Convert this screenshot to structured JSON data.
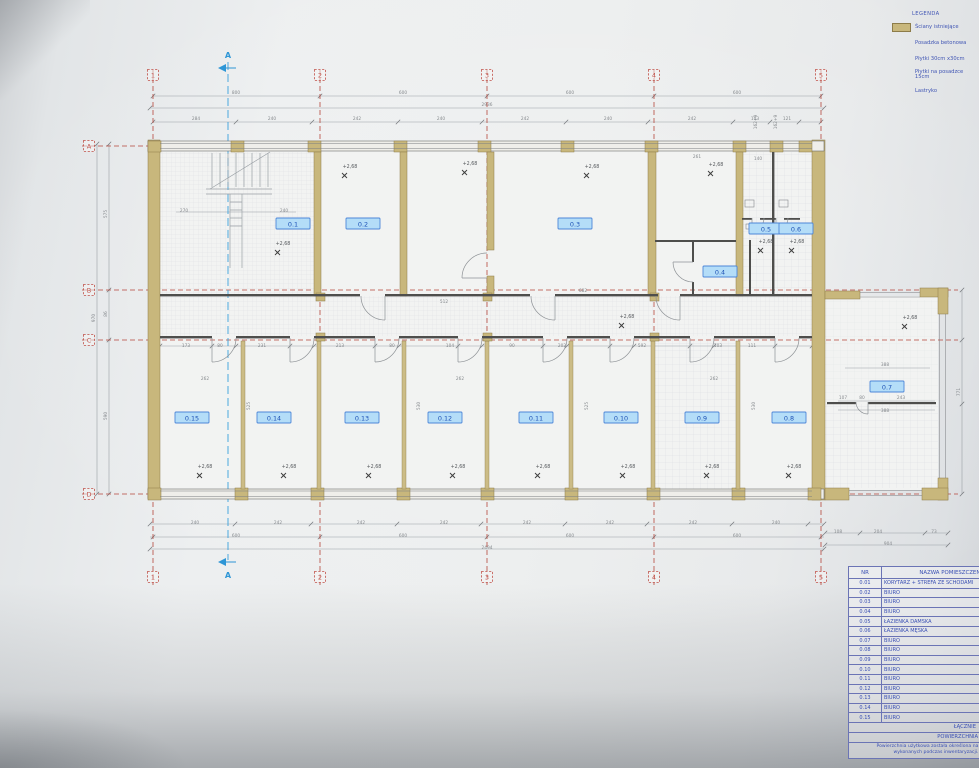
{
  "legend": {
    "title": "LEGENDA",
    "items": [
      {
        "label": "Ściany istniejące",
        "swatch": true
      },
      {
        "label": "Posadzka betonowa",
        "swatch": false
      },
      {
        "label": "Płytki 30cm x30cm",
        "swatch": false
      },
      {
        "label": "Płytki na posadzce 15cm",
        "swatch": false
      },
      {
        "label": "Lastryko",
        "swatch": false
      }
    ]
  },
  "plan": {
    "level_value": "+2,68",
    "section": {
      "label": "A"
    },
    "grid_cols": [
      {
        "label": "1",
        "x": 153
      },
      {
        "label": "2",
        "x": 320
      },
      {
        "label": "3",
        "x": 487
      },
      {
        "label": "4",
        "x": 654
      },
      {
        "label": "5",
        "x": 821
      }
    ],
    "grid_rows": [
      {
        "label": "A",
        "y": 146
      },
      {
        "label": "B",
        "y": 290
      },
      {
        "label": "C",
        "y": 340
      },
      {
        "label": "D",
        "y": 494
      }
    ],
    "room_labels": [
      {
        "id": "0.1",
        "x": 293,
        "y": 224
      },
      {
        "id": "0.2",
        "x": 363,
        "y": 224
      },
      {
        "id": "0.3",
        "x": 575,
        "y": 224
      },
      {
        "id": "0.4",
        "x": 720,
        "y": 272
      },
      {
        "id": "0.5",
        "x": 766,
        "y": 229
      },
      {
        "id": "0.6",
        "x": 796,
        "y": 229
      },
      {
        "id": "0.7",
        "x": 887,
        "y": 387
      },
      {
        "id": "0.8",
        "x": 789,
        "y": 418
      },
      {
        "id": "0.9",
        "x": 702,
        "y": 418
      },
      {
        "id": "0.10",
        "x": 621,
        "y": 418
      },
      {
        "id": "0.11",
        "x": 536,
        "y": 418
      },
      {
        "id": "0.12",
        "x": 445,
        "y": 418
      },
      {
        "id": "0.13",
        "x": 362,
        "y": 418
      },
      {
        "id": "0.14",
        "x": 274,
        "y": 418
      },
      {
        "id": "0.15",
        "x": 192,
        "y": 418
      }
    ],
    "level_markers": [
      {
        "x": 283,
        "y": 245
      },
      {
        "x": 350,
        "y": 168
      },
      {
        "x": 470,
        "y": 165
      },
      {
        "x": 592,
        "y": 168
      },
      {
        "x": 716,
        "y": 166
      },
      {
        "x": 766,
        "y": 243
      },
      {
        "x": 797,
        "y": 243
      },
      {
        "x": 627,
        "y": 318
      },
      {
        "x": 910,
        "y": 319
      },
      {
        "x": 205,
        "y": 468
      },
      {
        "x": 289,
        "y": 468
      },
      {
        "x": 374,
        "y": 468
      },
      {
        "x": 458,
        "y": 468
      },
      {
        "x": 543,
        "y": 468
      },
      {
        "x": 628,
        "y": 468
      },
      {
        "x": 712,
        "y": 468
      },
      {
        "x": 794,
        "y": 468
      }
    ],
    "dims": [
      {
        "t": "800",
        "x": 236,
        "y": 94
      },
      {
        "t": "600",
        "x": 403,
        "y": 94
      },
      {
        "t": "600",
        "x": 570,
        "y": 94
      },
      {
        "t": "600",
        "x": 737,
        "y": 94
      },
      {
        "t": "2936",
        "x": 487,
        "y": 106
      },
      {
        "t": "284",
        "x": 196,
        "y": 120
      },
      {
        "t": "240",
        "x": 272,
        "y": 120
      },
      {
        "t": "242",
        "x": 357,
        "y": 120
      },
      {
        "t": "240",
        "x": 441,
        "y": 120
      },
      {
        "t": "242",
        "x": 525,
        "y": 120
      },
      {
        "t": "240",
        "x": 608,
        "y": 120
      },
      {
        "t": "242",
        "x": 692,
        "y": 120
      },
      {
        "t": "103",
        "x": 755,
        "y": 120
      },
      {
        "t": "121",
        "x": 787,
        "y": 120
      },
      {
        "t": "270",
        "x": 184,
        "y": 212
      },
      {
        "t": "240",
        "x": 284,
        "y": 212
      },
      {
        "t": "261",
        "x": 697,
        "y": 158
      },
      {
        "t": "140",
        "x": 758,
        "y": 160
      },
      {
        "t": "162+9",
        "x": 757,
        "y": 122,
        "r": 1
      },
      {
        "t": "162+9",
        "x": 777,
        "y": 122,
        "r": 1
      },
      {
        "t": "682",
        "x": 583,
        "y": 292
      },
      {
        "t": "512",
        "x": 444,
        "y": 303
      },
      {
        "t": "173",
        "x": 186,
        "y": 347
      },
      {
        "t": "80",
        "x": 220,
        "y": 347
      },
      {
        "t": "231",
        "x": 262,
        "y": 347
      },
      {
        "t": "213",
        "x": 340,
        "y": 347
      },
      {
        "t": "80",
        "x": 392,
        "y": 347
      },
      {
        "t": "104",
        "x": 450,
        "y": 347
      },
      {
        "t": "90",
        "x": 512,
        "y": 347
      },
      {
        "t": "202",
        "x": 562,
        "y": 347
      },
      {
        "t": "592",
        "x": 642,
        "y": 347
      },
      {
        "t": "103",
        "x": 718,
        "y": 347
      },
      {
        "t": "111",
        "x": 752,
        "y": 347
      },
      {
        "t": "262",
        "x": 205,
        "y": 380
      },
      {
        "t": "262",
        "x": 460,
        "y": 380
      },
      {
        "t": "262",
        "x": 714,
        "y": 380
      },
      {
        "t": "525",
        "x": 250,
        "y": 406,
        "r": 1
      },
      {
        "t": "530",
        "x": 420,
        "y": 406,
        "r": 1
      },
      {
        "t": "525",
        "x": 588,
        "y": 406,
        "r": 1
      },
      {
        "t": "530",
        "x": 755,
        "y": 406,
        "r": 1
      },
      {
        "t": "388",
        "x": 885,
        "y": 366
      },
      {
        "t": "107",
        "x": 843,
        "y": 399
      },
      {
        "t": "80",
        "x": 862,
        "y": 399
      },
      {
        "t": "243",
        "x": 901,
        "y": 399
      },
      {
        "t": "388",
        "x": 885,
        "y": 412
      },
      {
        "t": "240",
        "x": 195,
        "y": 524
      },
      {
        "t": "242",
        "x": 278,
        "y": 524
      },
      {
        "t": "242",
        "x": 361,
        "y": 524
      },
      {
        "t": "242",
        "x": 444,
        "y": 524
      },
      {
        "t": "242",
        "x": 527,
        "y": 524
      },
      {
        "t": "242",
        "x": 610,
        "y": 524
      },
      {
        "t": "242",
        "x": 693,
        "y": 524
      },
      {
        "t": "240",
        "x": 776,
        "y": 524
      },
      {
        "t": "600",
        "x": 236,
        "y": 537
      },
      {
        "t": "600",
        "x": 403,
        "y": 537
      },
      {
        "t": "600",
        "x": 570,
        "y": 537
      },
      {
        "t": "600",
        "x": 737,
        "y": 537
      },
      {
        "t": "2494",
        "x": 487,
        "y": 549
      },
      {
        "t": "108",
        "x": 838,
        "y": 533
      },
      {
        "t": "204",
        "x": 878,
        "y": 533
      },
      {
        "t": "73",
        "x": 934,
        "y": 533
      },
      {
        "t": "904",
        "x": 888,
        "y": 545
      },
      {
        "t": "970",
        "x": 95,
        "y": 318,
        "r": 1
      },
      {
        "t": "575",
        "x": 107,
        "y": 214,
        "r": 1
      },
      {
        "t": "86",
        "x": 107,
        "y": 314,
        "r": 1
      },
      {
        "t": "590",
        "x": 107,
        "y": 416,
        "r": 1
      },
      {
        "t": "771",
        "x": 960,
        "y": 392,
        "r": 1
      }
    ]
  },
  "schedule": {
    "col_nr": "NR",
    "col_name": "NAZWA POMIESZCZENIA",
    "rows": [
      [
        "0.01",
        "KORYTARZ + STREFA ZE SCHODAMI"
      ],
      [
        "0.02",
        "BIURO"
      ],
      [
        "0.03",
        "BIURO"
      ],
      [
        "0.04",
        "BIURO"
      ],
      [
        "0.05",
        "ŁAZIENKA DAMSKA"
      ],
      [
        "0.06",
        "ŁAZIENKA MĘSKA"
      ],
      [
        "0.07",
        "BIURO"
      ],
      [
        "0.08",
        "BIURO"
      ],
      [
        "0.09",
        "BIURO"
      ],
      [
        "0.10",
        "BIURO"
      ],
      [
        "0.11",
        "BIURO"
      ],
      [
        "0.12",
        "BIURO"
      ],
      [
        "0.13",
        "BIURO"
      ],
      [
        "0.14",
        "BIURO"
      ],
      [
        "0.15",
        "BIURO"
      ]
    ],
    "total_label": "ŁĄCZNIE",
    "area_label": "POWIERZCHNIA UŻYTKOWA",
    "note_line1": "Powierzchnia użytkowa została określona na podsta",
    "note_line2": "wykonanych podczas inwentaryzacji."
  }
}
